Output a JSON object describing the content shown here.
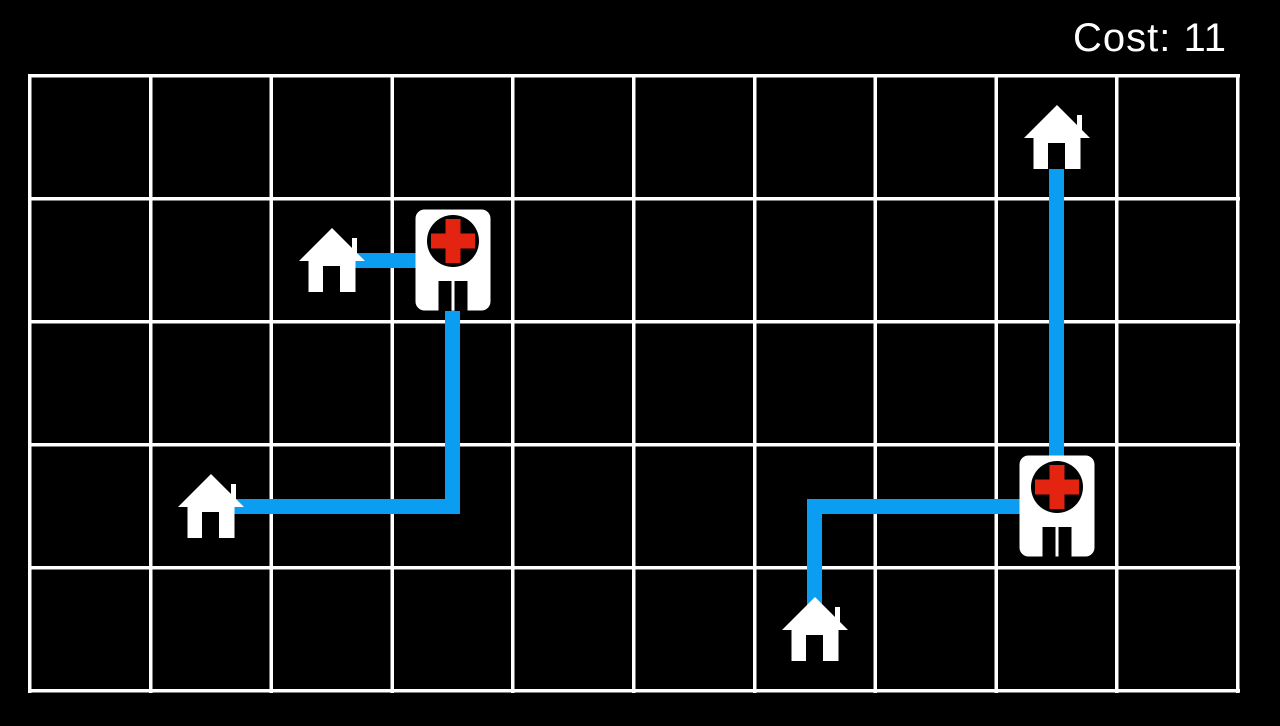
{
  "hud": {
    "cost_text": "Cost: 11"
  },
  "game": {
    "total_cost": 11
  },
  "colors": {
    "background": "#000000",
    "grid_line": "#ffffff",
    "route": "#0a9df2",
    "building_white": "#ffffff",
    "cross_red": "#e32410",
    "icon_dark": "#000000"
  },
  "board": {
    "columns": 10,
    "rows": 5,
    "origin": {
      "x": 28,
      "y": 74
    },
    "cell": {
      "width": 120.8,
      "height": 123
    },
    "line_thickness": 3.5,
    "route_thickness": 15
  },
  "entities": [
    {
      "id": "house-top-right",
      "type": "house",
      "icon": "house-icon",
      "col": 8,
      "row": 0
    },
    {
      "id": "house-mid-left",
      "type": "house",
      "icon": "house-icon",
      "col": 2,
      "row": 1
    },
    {
      "id": "hospital-left",
      "type": "hospital",
      "icon": "hospital-icon",
      "col": 3,
      "row": 1
    },
    {
      "id": "house-lower-left",
      "type": "house",
      "icon": "house-icon",
      "col": 1,
      "row": 3
    },
    {
      "id": "hospital-right",
      "type": "hospital",
      "icon": "hospital-icon",
      "col": 8,
      "row": 3
    },
    {
      "id": "house-bottom",
      "type": "house",
      "icon": "house-icon",
      "col": 6,
      "row": 4
    }
  ],
  "routes": [
    {
      "from": "house-mid-left",
      "to": "hospital-left",
      "cost": 1,
      "cells": [
        [
          2,
          1
        ],
        [
          3,
          1
        ]
      ]
    },
    {
      "from": "house-lower-left",
      "to": "hospital-left",
      "cost": 4,
      "cells": [
        [
          1,
          3
        ],
        [
          3,
          3
        ],
        [
          3,
          1
        ]
      ]
    },
    {
      "from": "house-top-right",
      "to": "hospital-right",
      "cost": 3,
      "cells": [
        [
          8,
          0
        ],
        [
          8,
          3
        ]
      ]
    },
    {
      "from": "house-bottom",
      "to": "hospital-right",
      "cost": 3,
      "cells": [
        [
          6,
          4
        ],
        [
          6,
          3
        ],
        [
          8,
          3
        ]
      ]
    }
  ]
}
